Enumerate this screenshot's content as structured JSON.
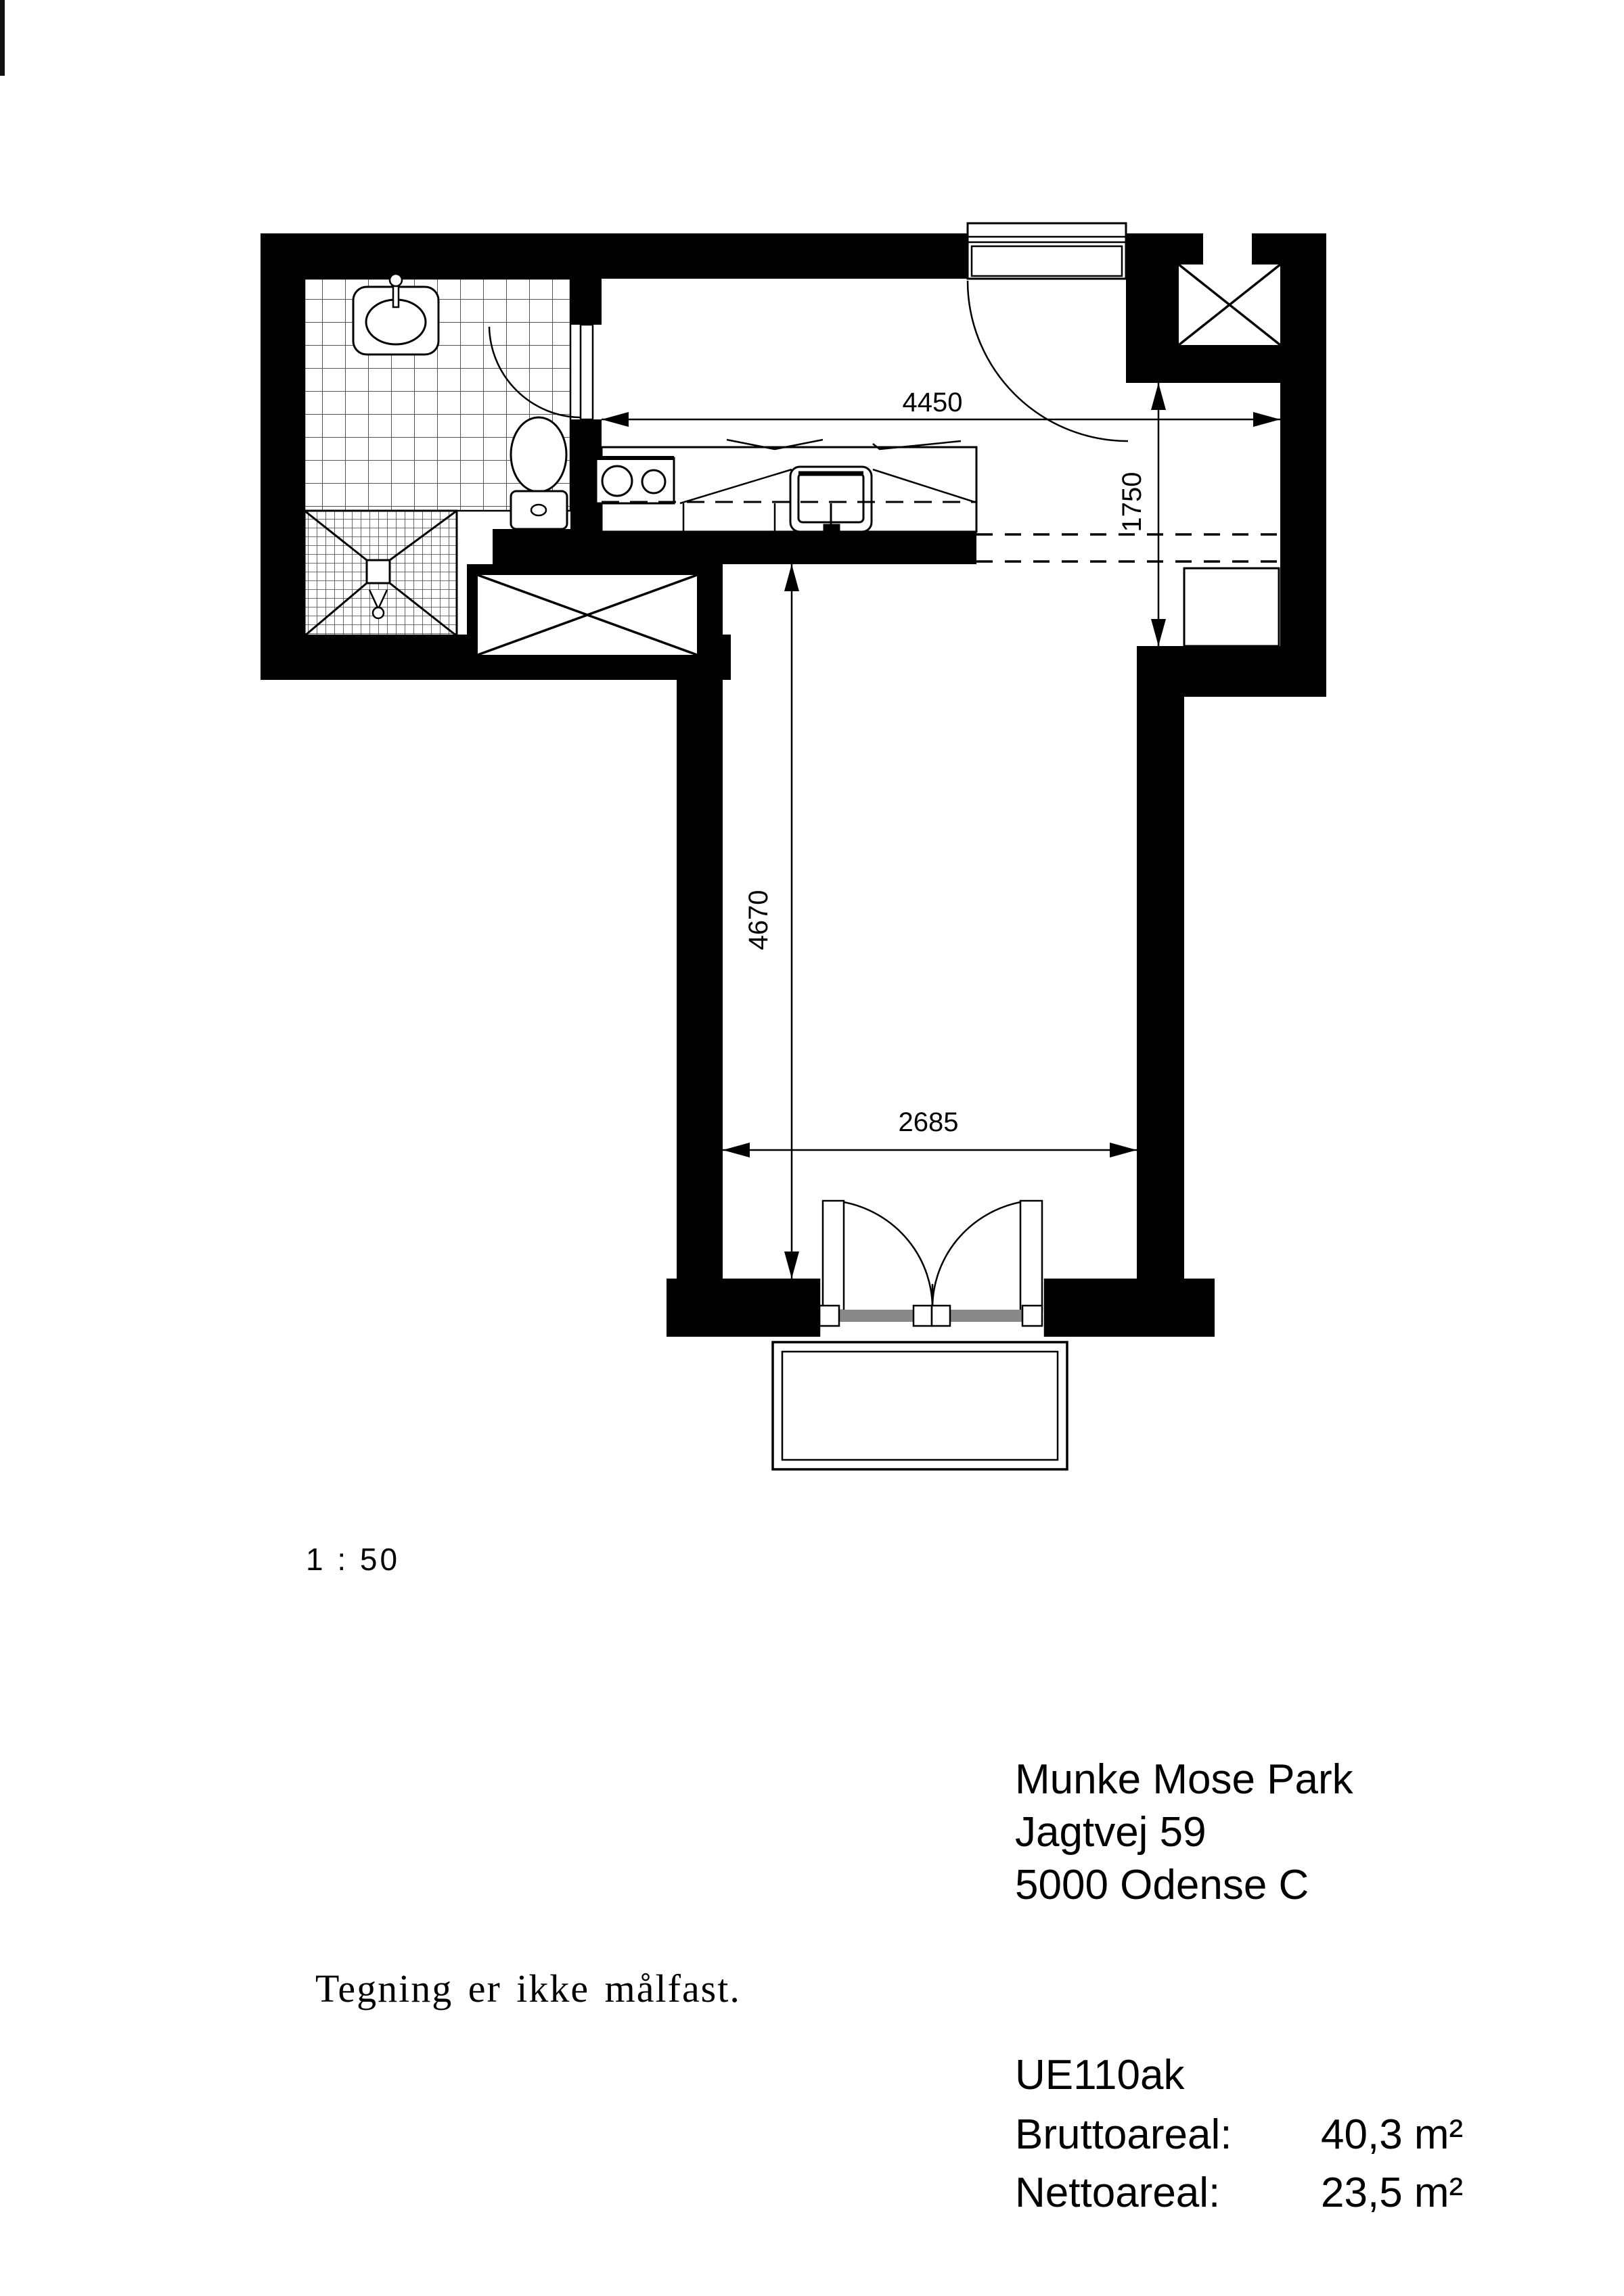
{
  "plan": {
    "scale_label": "1 : 50",
    "note": "Tegning er ikke målfast.",
    "dimensions": {
      "kitchen_width": "4450",
      "hall_depth": "1750",
      "room_length": "4670",
      "room_width": "2685"
    },
    "address": {
      "line1": "Munke Mose Park",
      "line2": "Jagtvej 59",
      "line3": "5000 Odense C"
    },
    "unit": {
      "id": "UE110ak",
      "gross_label": "Bruttoareal:",
      "gross_value": "40,3 m²",
      "net_label": "Nettoareal:",
      "net_value": "23,5 m²"
    }
  }
}
